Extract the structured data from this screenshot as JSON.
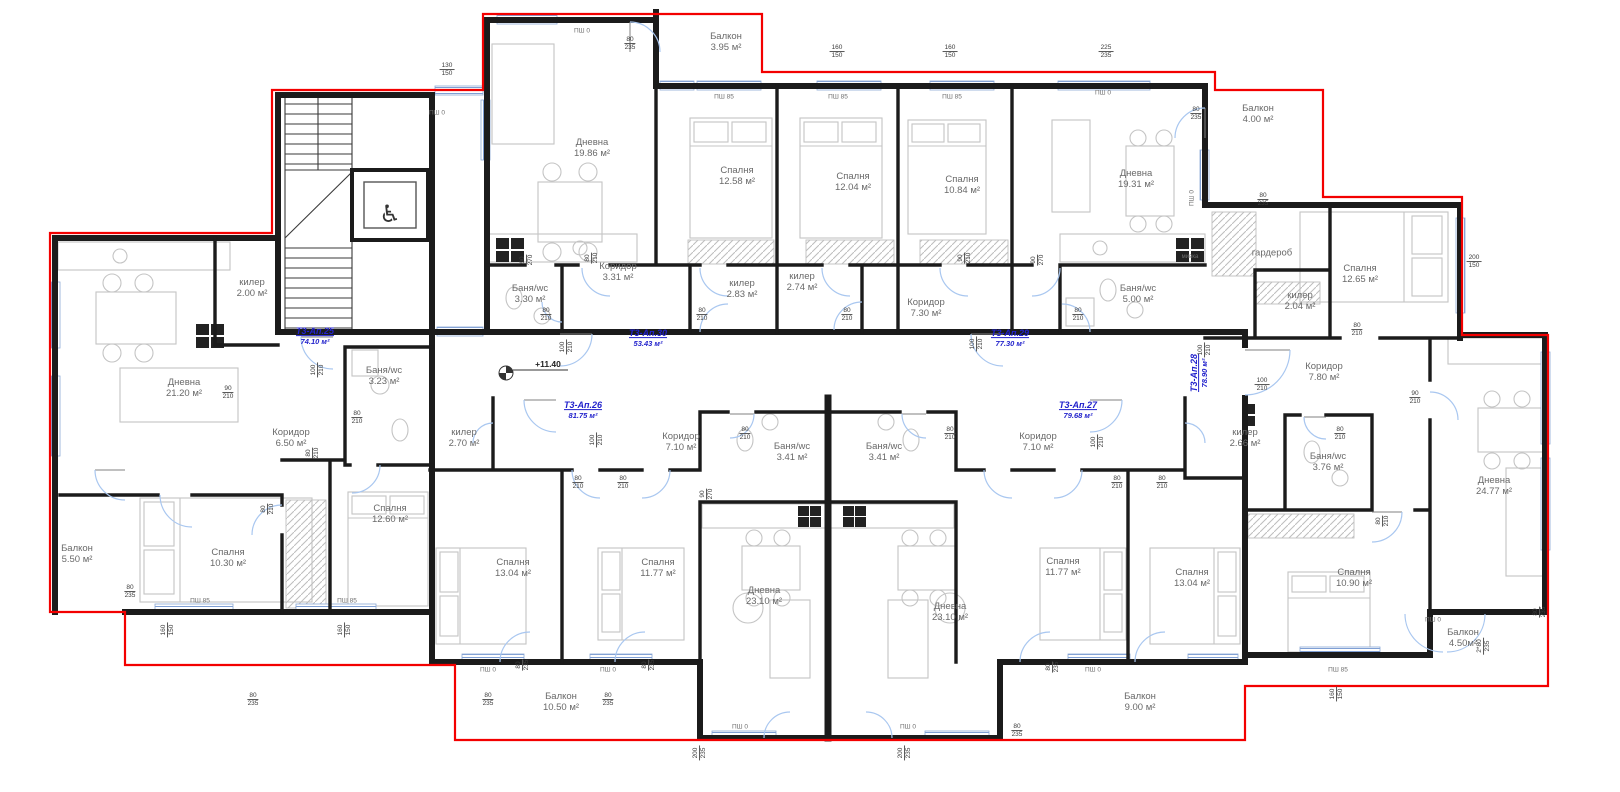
{
  "plan_title": "Етаж +11.40 — разпределение",
  "level_marker": {
    "text": "+11.40",
    "x": 548,
    "y": 364
  },
  "colors": {
    "walls": "#1b1b1b",
    "outline_red": "#f30000",
    "window_blue": "#7f9fd4",
    "door_arc": "#a9c7f0",
    "apartment_label_blue": "#2222cc",
    "room_text_gray": "#696969"
  },
  "apartments": [
    {
      "id": "Т3-Ап.25",
      "area": "74.10 м²",
      "x": 315,
      "y": 336,
      "r": 0
    },
    {
      "id": "Т3-Ап.30",
      "area": "53.43 м²",
      "x": 648,
      "y": 338,
      "r": 0
    },
    {
      "id": "Т3-Ап.29",
      "area": "77.30 м²",
      "x": 1010,
      "y": 338,
      "r": 0
    },
    {
      "id": "Т3-Ап.26",
      "area": "81.75 м²",
      "x": 583,
      "y": 410,
      "r": 0
    },
    {
      "id": "Т3-Ап.27",
      "area": "79.68 м²",
      "x": 1078,
      "y": 410,
      "r": 0
    },
    {
      "id": "Т3-Ап.28",
      "area": "78.90 м²",
      "x": 1199,
      "y": 373,
      "r": -90
    }
  ],
  "rooms": [
    {
      "label": "Дневна",
      "area": "19.86 м²",
      "x": 592,
      "y": 148
    },
    {
      "label": "Спалня",
      "area": "12.58 м²",
      "x": 737,
      "y": 176
    },
    {
      "label": "Спалня",
      "area": "12.04 м²",
      "x": 853,
      "y": 182
    },
    {
      "label": "Спалня",
      "area": "10.84 м²",
      "x": 962,
      "y": 185
    },
    {
      "label": "Дневна",
      "area": "19.31 м²",
      "x": 1136,
      "y": 179
    },
    {
      "label": "Балкон",
      "area": "3.95 м²",
      "x": 726,
      "y": 42
    },
    {
      "label": "Балкон",
      "area": "4.00 м²",
      "x": 1258,
      "y": 114
    },
    {
      "label": "гардероб",
      "area": "",
      "x": 1272,
      "y": 253
    },
    {
      "label": "Спалня",
      "area": "12.65 м²",
      "x": 1360,
      "y": 274
    },
    {
      "label": "Баня/wc",
      "area": "3.30 м²",
      "x": 530,
      "y": 294
    },
    {
      "label": "Коридор",
      "area": "3.31 м²",
      "x": 618,
      "y": 272
    },
    {
      "label": "килер",
      "area": "2.83 м²",
      "x": 742,
      "y": 289
    },
    {
      "label": "килер",
      "area": "2.74 м²",
      "x": 802,
      "y": 282
    },
    {
      "label": "Коридор",
      "area": "7.30 м²",
      "x": 926,
      "y": 308
    },
    {
      "label": "Баня/wc",
      "area": "5.00 м²",
      "x": 1138,
      "y": 294
    },
    {
      "label": "килер",
      "area": "2.04 м²",
      "x": 1300,
      "y": 301
    },
    {
      "label": "килер",
      "area": "2.00 м²",
      "x": 252,
      "y": 288
    },
    {
      "label": "Дневна",
      "area": "21.20 м²",
      "x": 184,
      "y": 388
    },
    {
      "label": "Коридор",
      "area": "6.50 м²",
      "x": 291,
      "y": 438
    },
    {
      "label": "Баня/wc",
      "area": "3.23 м²",
      "x": 384,
      "y": 376
    },
    {
      "label": "Балкон",
      "area": "5.50 м²",
      "x": 77,
      "y": 554
    },
    {
      "label": "Спалня",
      "area": "10.30 м²",
      "x": 228,
      "y": 558
    },
    {
      "label": "Спалня",
      "area": "12.60 м²",
      "x": 390,
      "y": 514
    },
    {
      "label": "килер",
      "area": "2.70 м²",
      "x": 464,
      "y": 438
    },
    {
      "label": "Коридор",
      "area": "7.10 м²",
      "x": 681,
      "y": 442
    },
    {
      "label": "Баня/wc",
      "area": "3.41 м²",
      "x": 792,
      "y": 452
    },
    {
      "label": "Спалня",
      "area": "13.04 м²",
      "x": 513,
      "y": 568
    },
    {
      "label": "Спалня",
      "area": "11.77 м²",
      "x": 658,
      "y": 568
    },
    {
      "label": "Дневна",
      "area": "23.10 м²",
      "x": 764,
      "y": 596
    },
    {
      "label": "Балкон",
      "area": "10.50 м²",
      "x": 561,
      "y": 702
    },
    {
      "label": "Баня/wc",
      "area": "3.41 м²",
      "x": 884,
      "y": 452
    },
    {
      "label": "Коридор",
      "area": "7.10 м²",
      "x": 1038,
      "y": 442
    },
    {
      "label": "килер",
      "area": "2.66 м²",
      "x": 1245,
      "y": 438
    },
    {
      "label": "Дневна",
      "area": "23.10 м²",
      "x": 950,
      "y": 612
    },
    {
      "label": "Спалня",
      "area": "11.77 м²",
      "x": 1063,
      "y": 567
    },
    {
      "label": "Спалня",
      "area": "13.04 м²",
      "x": 1192,
      "y": 578
    },
    {
      "label": "Балкон",
      "area": "9.00 м²",
      "x": 1140,
      "y": 702
    },
    {
      "label": "Коридор",
      "area": "7.80 м²",
      "x": 1324,
      "y": 372
    },
    {
      "label": "Баня/wc",
      "area": "3.76 м²",
      "x": 1328,
      "y": 462
    },
    {
      "label": "Дневна",
      "area": "24.77 м²",
      "x": 1494,
      "y": 486
    },
    {
      "label": "Спалня",
      "area": "10.90 м²",
      "x": 1354,
      "y": 578
    },
    {
      "label": "Балкон",
      "area": "4.50м²",
      "x": 1463,
      "y": 638
    }
  ],
  "dims": [
    {
      "t": "130",
      "b": "150",
      "x": 447,
      "y": 70,
      "r": 0
    },
    {
      "t": "80",
      "b": "235",
      "x": 630,
      "y": 44,
      "r": 0
    },
    {
      "t": "160",
      "b": "150",
      "x": 837,
      "y": 52,
      "r": 0
    },
    {
      "t": "160",
      "b": "150",
      "x": 950,
      "y": 52,
      "r": 0
    },
    {
      "t": "225",
      "b": "235",
      "x": 1106,
      "y": 52,
      "r": 0
    },
    {
      "t": "80",
      "b": "235",
      "x": 1196,
      "y": 114,
      "r": 0
    },
    {
      "t": "80",
      "b": "235",
      "x": 1263,
      "y": 200,
      "r": 0
    },
    {
      "t": "200",
      "b": "150",
      "x": 1474,
      "y": 262,
      "r": 0
    },
    {
      "t": "90",
      "b": "270",
      "x": 527,
      "y": 260,
      "r": 90
    },
    {
      "t": "80",
      "b": "210",
      "x": 592,
      "y": 258,
      "r": 90
    },
    {
      "t": "80",
      "b": "210",
      "x": 546,
      "y": 315,
      "r": 0
    },
    {
      "t": "100",
      "b": "210",
      "x": 567,
      "y": 347,
      "r": 90
    },
    {
      "t": "80",
      "b": "210",
      "x": 702,
      "y": 315,
      "r": 0
    },
    {
      "t": "80",
      "b": "210",
      "x": 847,
      "y": 315,
      "r": 0
    },
    {
      "t": "90",
      "b": "210",
      "x": 965,
      "y": 258,
      "r": 90
    },
    {
      "t": "100",
      "b": "210",
      "x": 977,
      "y": 344,
      "r": 90
    },
    {
      "t": "90",
      "b": "270",
      "x": 1038,
      "y": 260,
      "r": 90
    },
    {
      "t": "80",
      "b": "210",
      "x": 1078,
      "y": 315,
      "r": 0
    },
    {
      "t": "100",
      "b": "210",
      "x": 1205,
      "y": 350,
      "r": 90
    },
    {
      "t": "100",
      "b": "210",
      "x": 1262,
      "y": 385,
      "r": 0
    },
    {
      "t": "100",
      "b": "210",
      "x": 318,
      "y": 370,
      "r": 90
    },
    {
      "t": "90",
      "b": "210",
      "x": 228,
      "y": 393,
      "r": 0
    },
    {
      "t": "80",
      "b": "210",
      "x": 357,
      "y": 418,
      "r": 0
    },
    {
      "t": "80",
      "b": "210",
      "x": 313,
      "y": 453,
      "r": 90
    },
    {
      "t": "80",
      "b": "210",
      "x": 268,
      "y": 509,
      "r": 90
    },
    {
      "t": "80",
      "b": "235",
      "x": 130,
      "y": 592,
      "r": 0
    },
    {
      "t": "80",
      "b": "235",
      "x": 253,
      "y": 700,
      "r": 0
    },
    {
      "t": "160",
      "b": "150",
      "x": 168,
      "y": 630,
      "r": 90
    },
    {
      "t": "160",
      "b": "150",
      "x": 345,
      "y": 630,
      "r": 90
    },
    {
      "t": "100",
      "b": "210",
      "x": 597,
      "y": 440,
      "r": 90
    },
    {
      "t": "80",
      "b": "210",
      "x": 745,
      "y": 434,
      "r": 0
    },
    {
      "t": "90",
      "b": "270",
      "x": 707,
      "y": 494,
      "r": 90
    },
    {
      "t": "80",
      "b": "210",
      "x": 950,
      "y": 434,
      "r": 0
    },
    {
      "t": "100",
      "b": "210",
      "x": 1098,
      "y": 442,
      "r": 90
    },
    {
      "t": "80",
      "b": "210",
      "x": 578,
      "y": 483,
      "r": 0
    },
    {
      "t": "80",
      "b": "210",
      "x": 623,
      "y": 483,
      "r": 0
    },
    {
      "t": "80",
      "b": "210",
      "x": 1117,
      "y": 483,
      "r": 0
    },
    {
      "t": "80",
      "b": "210",
      "x": 1162,
      "y": 483,
      "r": 0
    },
    {
      "t": "80",
      "b": "235",
      "x": 523,
      "y": 665,
      "r": 90
    },
    {
      "t": "80",
      "b": "235",
      "x": 649,
      "y": 665,
      "r": 90
    },
    {
      "t": "80",
      "b": "235",
      "x": 488,
      "y": 700,
      "r": 0
    },
    {
      "t": "80",
      "b": "235",
      "x": 608,
      "y": 700,
      "r": 0
    },
    {
      "t": "80",
      "b": "235",
      "x": 1053,
      "y": 667,
      "r": 90
    },
    {
      "t": "80",
      "b": "235",
      "x": 1017,
      "y": 731,
      "r": 0
    },
    {
      "t": "200",
      "b": "235",
      "x": 700,
      "y": 753,
      "r": 90
    },
    {
      "t": "200",
      "b": "235",
      "x": 905,
      "y": 753,
      "r": 90
    },
    {
      "t": "80",
      "b": "210",
      "x": 1357,
      "y": 330,
      "r": 0
    },
    {
      "t": "90",
      "b": "210",
      "x": 1415,
      "y": 398,
      "r": 0
    },
    {
      "t": "80",
      "b": "210",
      "x": 1340,
      "y": 434,
      "r": 0
    },
    {
      "t": "80",
      "b": "210",
      "x": 1383,
      "y": 521,
      "r": 90
    },
    {
      "t": "160",
      "b": "150",
      "x": 1337,
      "y": 694,
      "r": 90
    },
    {
      "t": "80",
      "b": "235",
      "x": 1540,
      "y": 612,
      "r": 90
    },
    {
      "t": "2*80",
      "b": "235",
      "x": 1484,
      "y": 646,
      "r": 90
    }
  ],
  "window_labels": [
    {
      "text": "ПШ 0",
      "x": 582,
      "y": 31,
      "r": 0
    },
    {
      "text": "ПШ 85",
      "x": 724,
      "y": 97,
      "r": 0
    },
    {
      "text": "ПШ 85",
      "x": 838,
      "y": 97,
      "r": 0
    },
    {
      "text": "ПШ 85",
      "x": 952,
      "y": 97,
      "r": 0
    },
    {
      "text": "ПШ 0",
      "x": 1103,
      "y": 93,
      "r": 0
    },
    {
      "text": "ПШ 0",
      "x": 437,
      "y": 113,
      "r": 0
    },
    {
      "text": "ПШ 0",
      "x": 1192,
      "y": 198,
      "r": 90
    },
    {
      "text": "ПШ 85",
      "x": 200,
      "y": 601,
      "r": 0
    },
    {
      "text": "ПШ 85",
      "x": 347,
      "y": 601,
      "r": 0
    },
    {
      "text": "ПШ 0",
      "x": 488,
      "y": 670,
      "r": 0
    },
    {
      "text": "ПШ 0",
      "x": 608,
      "y": 670,
      "r": 0
    },
    {
      "text": "ПШ 0",
      "x": 740,
      "y": 727,
      "r": 0
    },
    {
      "text": "ПШ 0",
      "x": 908,
      "y": 727,
      "r": 0
    },
    {
      "text": "ПШ 0",
      "x": 1093,
      "y": 670,
      "r": 0
    },
    {
      "text": "ПШ 85",
      "x": 1338,
      "y": 670,
      "r": 0
    },
    {
      "text": "ПШ 0",
      "x": 1433,
      "y": 620,
      "r": 0
    }
  ],
  "misc_labels": [
    {
      "text": "мивка",
      "x": 1190,
      "y": 257
    }
  ]
}
